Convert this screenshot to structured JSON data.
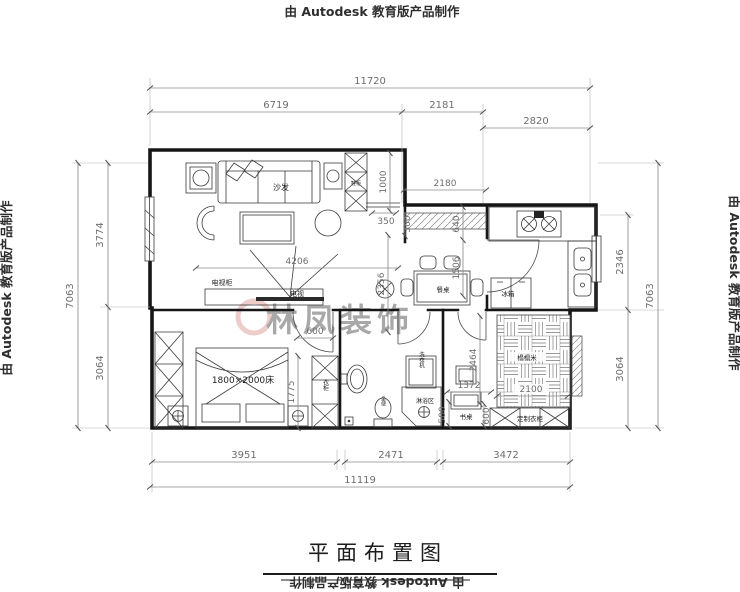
{
  "edge": {
    "top": "由 Autodesk 教育版产品制作",
    "left": "由 Autodesk 教育版产品制作",
    "right": "由 Autodesk 教育版产品制作",
    "bottom": "由 Autodesk 教育版产品制作"
  },
  "title": "平面布置图",
  "watermark": {
    "text": "林凤装饰",
    "color": "#cf7d74"
  },
  "dims": {
    "top_overall": "11720",
    "top_left": "6719",
    "top_mid": "2181",
    "top_right": "2820",
    "left_overall": "7063",
    "left_upper": "3774",
    "left_lower": "3064",
    "right_overall": "7063",
    "right_upper": "2346",
    "right_lower": "3064",
    "bottom_left": "3951",
    "bottom_mid": "2471",
    "bottom_right": "3472",
    "bottom_overall": "11119",
    "living_width": "4206",
    "entry_cab": "1000",
    "entry_gap": "350",
    "d300": "300",
    "dining_width": "2180",
    "dining_depth": "2356",
    "d640": "640",
    "d1506": "1506",
    "door600": "600",
    "bed_side": "1775",
    "desk_w": "1372",
    "tatami_h": "2464",
    "tatami_w": "2100",
    "d500": "500",
    "d600b": "600"
  },
  "labels": {
    "sofa": "沙发",
    "tv_cabinet": "电视柜",
    "tv": "电视",
    "shoe_cabinet": "鞋柜",
    "dining_table": "餐桌",
    "fridge": "冰箱",
    "bed": "1800×2000床",
    "wardrobe": "衣柜",
    "washer": "洗衣机",
    "toilet": "坐便",
    "shower": "淋浴区",
    "desk": "书桌",
    "tatami": "榻榻米",
    "custom_wardrobe": "定制衣柜"
  }
}
